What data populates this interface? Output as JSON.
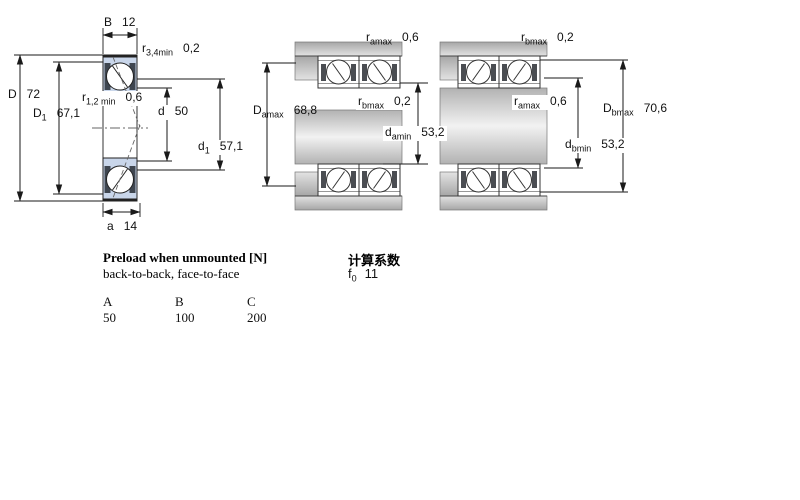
{
  "figures": {
    "single_bearing": {
      "labels": {
        "B": {
          "sym": "B",
          "sub": "",
          "value": "12"
        },
        "r34": {
          "sym": "r",
          "sub": "3,4min",
          "value": "0,2"
        },
        "D": {
          "sym": "D",
          "sub": "",
          "value": "72"
        },
        "D1": {
          "sym": "D",
          "sub": "1",
          "value": "67,1"
        },
        "r12": {
          "sym": "r",
          "sub": "1,2 min",
          "value": "0,6"
        },
        "d": {
          "sym": "d",
          "sub": "",
          "value": "50"
        },
        "d1": {
          "sym": "d",
          "sub": "1",
          "value": "57,1"
        },
        "a": {
          "sym": "a",
          "sub": "",
          "value": "14"
        }
      }
    },
    "arrangement_a": {
      "labels": {
        "ramax": {
          "sym": "r",
          "sub": "amax",
          "value": "0,6"
        },
        "Damax": {
          "sym": "D",
          "sub": "amax",
          "value": "68,8"
        },
        "rbmax": {
          "sym": "r",
          "sub": "bmax",
          "value": "0,2"
        },
        "damin": {
          "sym": "d",
          "sub": "amin",
          "value": "53,2"
        }
      }
    },
    "arrangement_b": {
      "labels": {
        "rbmax": {
          "sym": "r",
          "sub": "bmax",
          "value": "0,2"
        },
        "ramax": {
          "sym": "r",
          "sub": "amax",
          "value": "0,6"
        },
        "Dbmax": {
          "sym": "D",
          "sub": "bmax",
          "value": "70,6"
        },
        "dbmin": {
          "sym": "d",
          "sub": "bmin",
          "value": "53,2"
        }
      }
    }
  },
  "preload": {
    "title": "Preload when unmounted [N]",
    "subtitle": "back-to-back, face-to-face",
    "columns": [
      "A",
      "B",
      "C"
    ],
    "values": [
      "50",
      "100",
      "200"
    ]
  },
  "calculation": {
    "title": "计算系数",
    "f0": {
      "sym": "f",
      "sub": "0",
      "value": "11"
    }
  },
  "colors": {
    "bearing_blue": "#c9d6ea",
    "hatch_dark": "#3f4650",
    "steel_gray": "#b9b9b9",
    "line": "#1a1a1a"
  }
}
